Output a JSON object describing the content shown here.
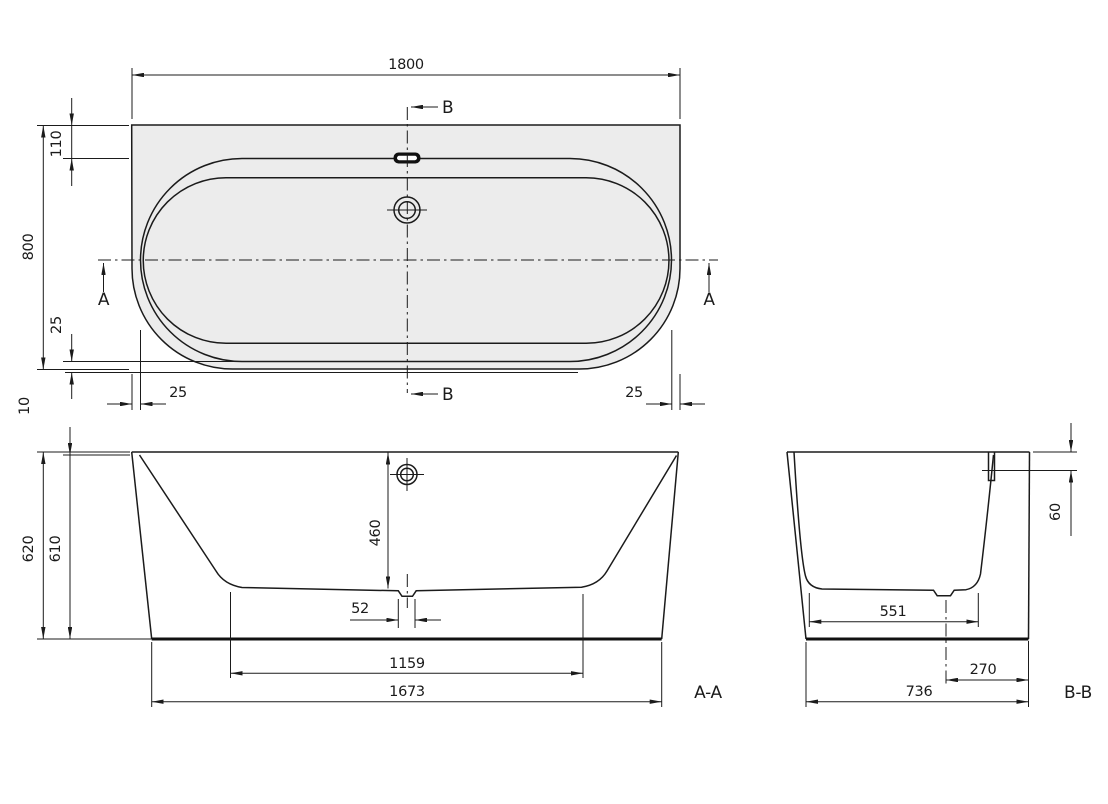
{
  "drawing": {
    "kind": "bathtub technical drawing, plan view with two cross sections",
    "line_color": "#1b1b1b",
    "plan_fill_color": "#ececec",
    "plan": {
      "length": "1800",
      "depth": "800",
      "rim_back_width": "110",
      "rim_front_gap": "25",
      "side_gap_left": "25",
      "side_gap_right": "25",
      "apron_offset": "10",
      "section_mark_a": "A",
      "section_mark_b": "B"
    },
    "section_aa": {
      "label": "A-A",
      "overall_height": "620",
      "inner_height": "610",
      "depth_to_floor": "460",
      "drain_recess_width": "52",
      "floor_length": "1159",
      "base_length": "1673"
    },
    "section_bb": {
      "label": "B-B",
      "overflow_depth": "60",
      "floor_width": "551",
      "drain_offset_from_back": "270",
      "base_width": "736"
    }
  }
}
